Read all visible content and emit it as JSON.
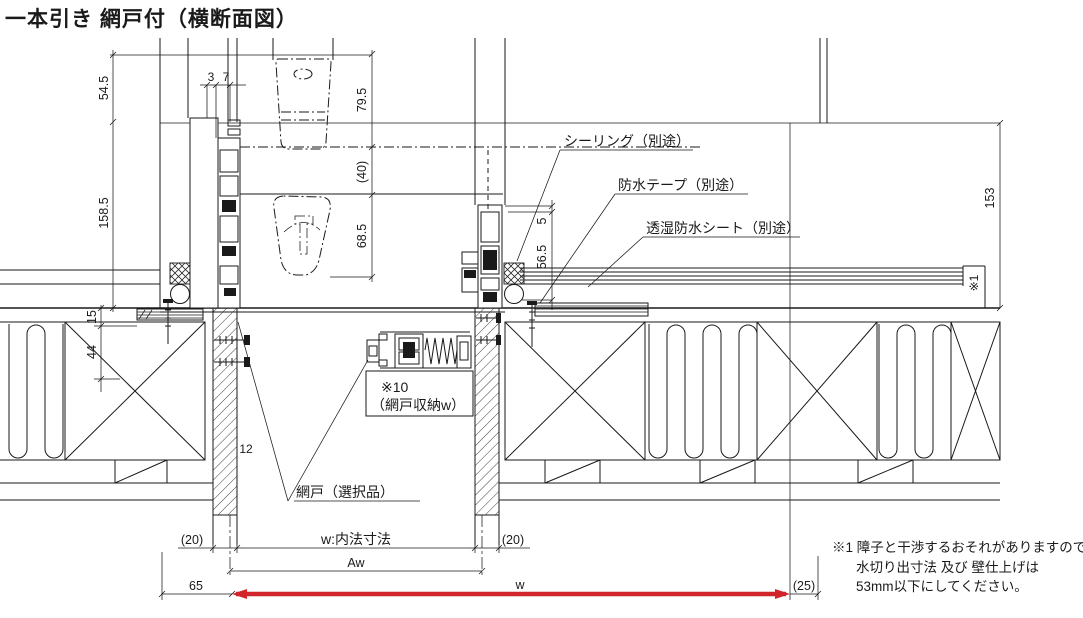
{
  "title": "一本引き 網戸付（横断面図）",
  "colors": {
    "ink": "#1a1a1a",
    "accent_red": "#d0262b",
    "background": "#ffffff"
  },
  "callouts": {
    "sealing": "シーリング（別途）",
    "waterproof_tape": "防水テープ（別途）",
    "breathable_sheet": "透湿防水シート（別途）",
    "screen_pocket_ref": "※10",
    "screen_pocket": "（網戸収納w）",
    "screen_door": "網戸（選択品）",
    "wall_note_ref": "※1"
  },
  "dimensions": {
    "head_a": "54.5",
    "head_b": "3",
    "head_c": "7",
    "handle_a": "79.5",
    "handle_b": "(40)",
    "handle_c": "68.5",
    "left_a": "158.5",
    "left_b": "15",
    "left_c": "44",
    "left_d": "12",
    "right_a": "5",
    "right_b": "56.5",
    "right_c": "153",
    "gap_left": "(20)",
    "inner_width": "w:内法寸法",
    "gap_right": "(20)",
    "aw": "Aw",
    "offset_left": "65",
    "overall_w": "w",
    "offset_right": "(25)"
  },
  "note": {
    "line1": "※1 障子と干渉するおそれがありますので",
    "line2": "水切り出寸法 及び 壁仕上げは",
    "line3": "53mm以下にしてください。"
  }
}
